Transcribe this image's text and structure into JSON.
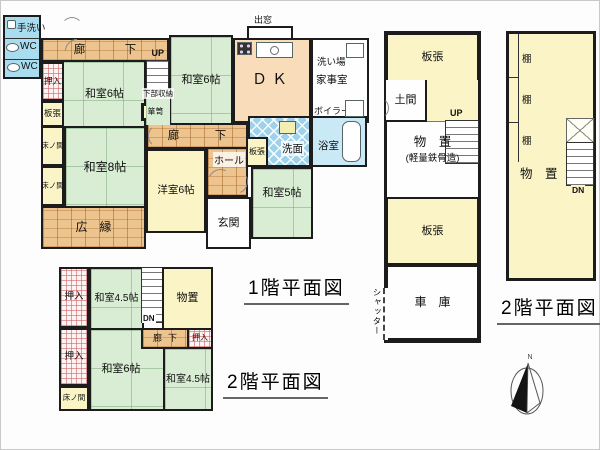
{
  "titles": {
    "floor1": "1階平面図",
    "floor2_left": "2階平面図",
    "floor2_right": "2階平面図"
  },
  "main_floor1": {
    "tearai": "手洗い",
    "wc1": "WC",
    "wc2": "WC",
    "corridor_top": "廊　下",
    "up": "UP",
    "lower_storage": "下部収納",
    "washitsu6_a": "和室6帖",
    "oshiire": "押入",
    "itabari_a": "板張",
    "washitsu6_b": "和室6帖",
    "tansu": "箪笥",
    "bay_window": "出窓",
    "dk": "ＤＫ",
    "araiba": "洗い場",
    "kajishitsu": "家事室",
    "boiler": "ボイラー",
    "corridor_mid": "廊　下",
    "hall": "ホール",
    "itabari_b": "板張",
    "senmen": "洗面",
    "yokushitsu": "浴室",
    "youshitsu6": "洋室6帖",
    "genkan": "玄関",
    "washitsu5": "和室5帖",
    "washitsu8": "和室8帖",
    "tokonoma_a": "床ノ間",
    "tokonoma_b": "床ノ間",
    "hiroen": "広　縁"
  },
  "main_floor2": {
    "oshiire_a": "押入",
    "washitsu45_a": "和室4.5帖",
    "monooki": "物置",
    "dn": "DN",
    "corridor": "廊下",
    "oshiire_b": "押入",
    "oshiire_c": "押入",
    "washitsu6": "和室6帖",
    "washitsu45_b": "和室4.5帖",
    "tokonoma": "床ノ間"
  },
  "annex_floor1": {
    "itabari_top": "板張",
    "doma": "土間",
    "up": "UP",
    "monooki_line1": "物　置",
    "monooki_line2": "(軽量鉄骨造)",
    "itabari_bottom": "板張",
    "garage": "車　庫",
    "shutter": "シャッター"
  },
  "annex_floor2": {
    "shelf1": "棚",
    "shelf2": "棚",
    "shelf3": "棚",
    "monooki": "物　置",
    "dn": "DN"
  },
  "compass": {
    "north": "N"
  }
}
